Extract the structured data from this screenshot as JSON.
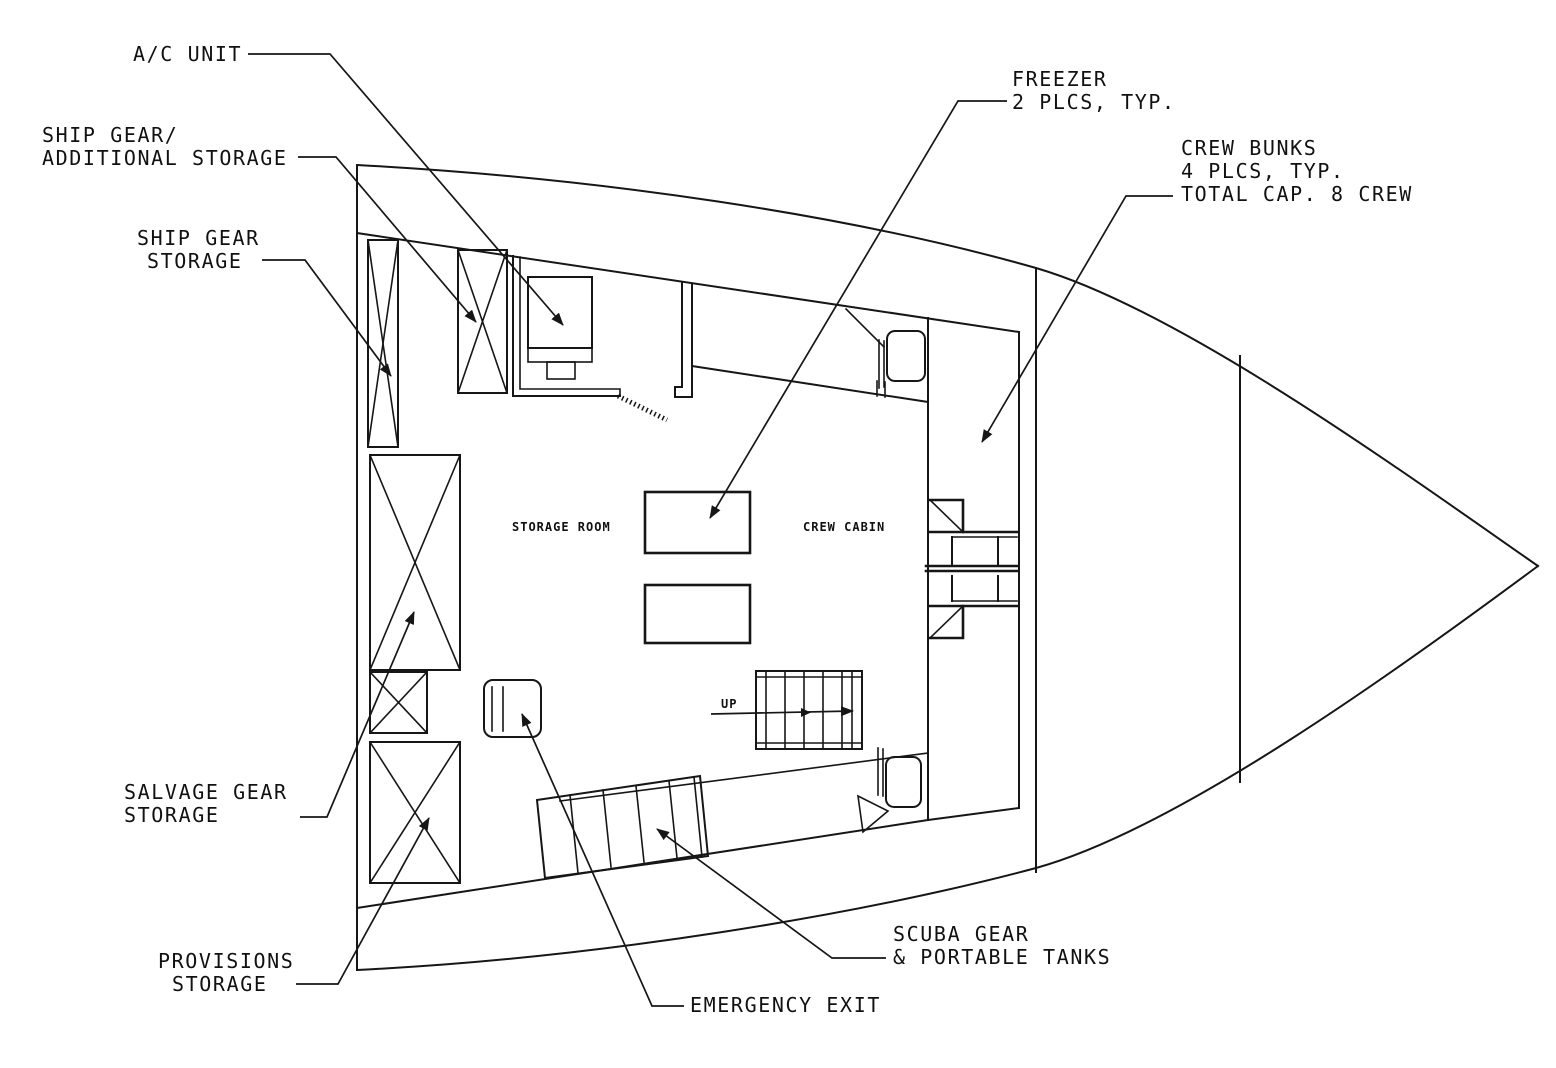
{
  "drawing": {
    "type": "boat lower-deck floor plan",
    "rooms": {
      "storage_room": "STORAGE ROOM",
      "crew_cabin": "CREW CABIN"
    },
    "stairs": {
      "direction_label": "UP"
    },
    "callouts": {
      "ac_unit": {
        "lines": [
          "A/C UNIT"
        ]
      },
      "ship_gear_additional": {
        "lines": [
          "SHIP GEAR/",
          "ADDITIONAL STORAGE"
        ]
      },
      "ship_gear_storage": {
        "lines": [
          "SHIP GEAR",
          "STORAGE"
        ]
      },
      "freezer": {
        "lines": [
          "FREEZER",
          "2 PLCS, TYP."
        ]
      },
      "crew_bunks": {
        "lines": [
          "CREW BUNKS",
          "4 PLCS, TYP.",
          "TOTAL CAP. 8 CREW"
        ]
      },
      "salvage_gear": {
        "lines": [
          "SALVAGE GEAR",
          "STORAGE"
        ]
      },
      "provisions": {
        "lines": [
          "PROVISIONS",
          "STORAGE"
        ]
      },
      "emergency_exit": {
        "lines": [
          "EMERGENCY EXIT"
        ]
      },
      "scuba_gear": {
        "lines": [
          "SCUBA GEAR",
          "& PORTABLE TANKS"
        ]
      }
    },
    "colors": {
      "line": "#161616",
      "background": "#ffffff"
    }
  }
}
